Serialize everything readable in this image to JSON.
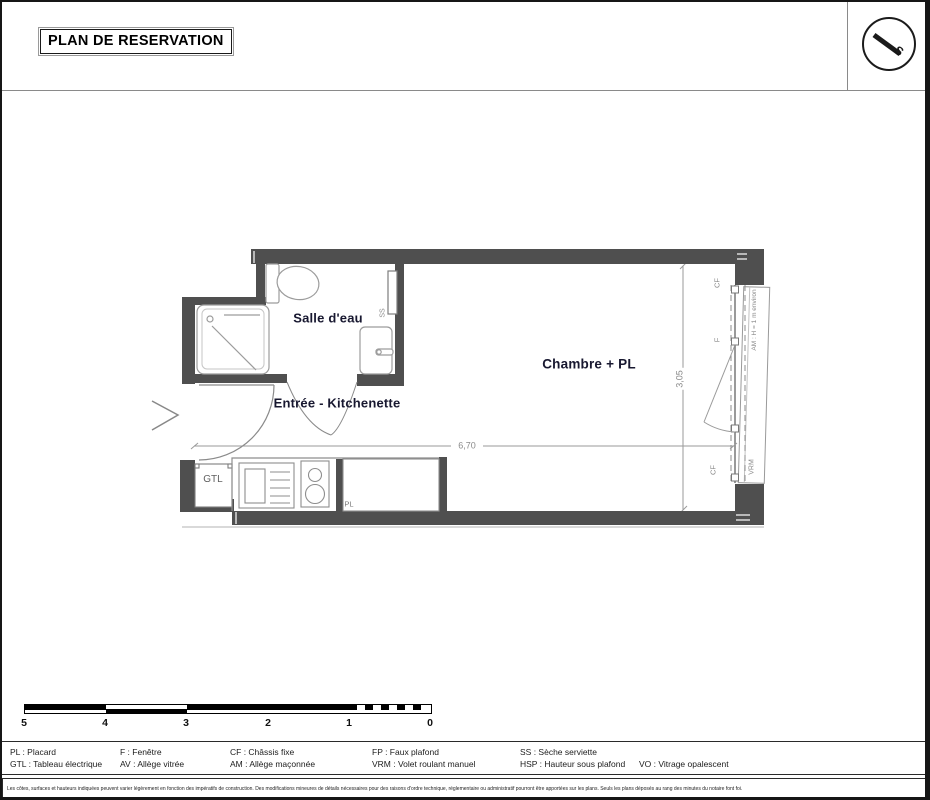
{
  "title": "PLAN DE RESERVATION",
  "compass": {
    "south_label": "S"
  },
  "rooms": {
    "bathroom": "Salle d'eau",
    "entry": "Entrée - Kitchenette",
    "bedroom": "Chambre + PL"
  },
  "annotations": {
    "gtl": "GTL",
    "pl": "PL",
    "ss": "SS",
    "cf_top": "CF",
    "f": "F",
    "cf_bottom": "CF",
    "am_note": "AM : H = 1 m environ",
    "vrm": "VRM"
  },
  "dimensions": {
    "length": "6,70",
    "depth": "3,05"
  },
  "scalebar": {
    "labels": [
      "5",
      "4",
      "3",
      "2",
      "1",
      "0"
    ]
  },
  "legend": {
    "items": [
      {
        "text": "PL : Placard"
      },
      {
        "text": "GTL : Tableau électrique"
      },
      {
        "text": "F : Fenêtre"
      },
      {
        "text": "AV : Allège vitrée"
      },
      {
        "text": "CF : Châssis fixe"
      },
      {
        "text": "AM : Allège maçonnée"
      },
      {
        "text": "FP : Faux plafond"
      },
      {
        "text": "VRM : Volet roulant manuel"
      },
      {
        "text": "SS : Sèche serviette"
      },
      {
        "text": "HSP : Hauteur sous plafond"
      },
      {
        "text": "VO : Vitrage opalescent"
      }
    ]
  },
  "disclaimer": "Les côtes, surfaces et hauteurs indiquées peuvent varier légèrement en fonction des impératifs de construction. Des modifications mineures de détails nécessaires pour des raisons d'ordre technique, réglementaire ou administratif pourront être apportées sur les plans. Seuls les plans déposés au rang des minutes du notaire font foi.",
  "colors": {
    "wall": "#4f4f4f",
    "thin_line": "#8e8e8e",
    "room_label": "#181830",
    "annotation": "#8a8a8a"
  }
}
